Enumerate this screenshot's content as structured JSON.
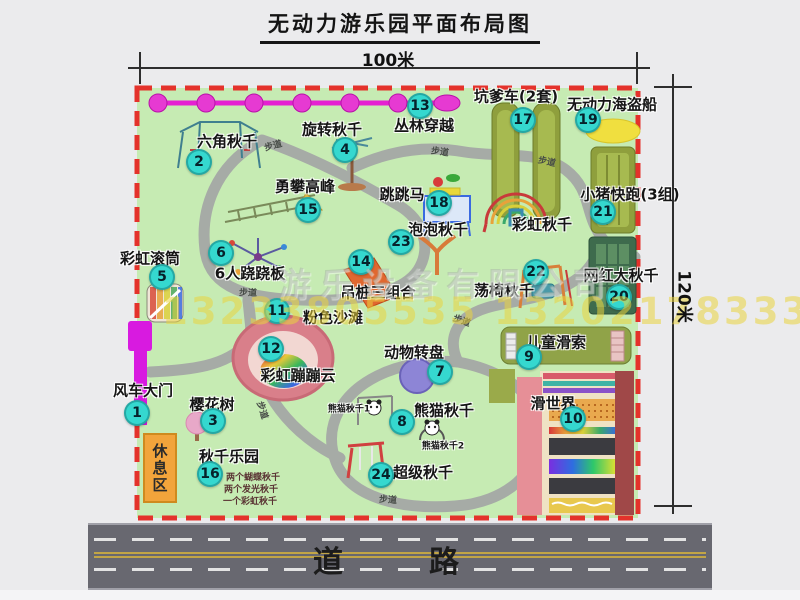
{
  "title": "无动力游乐园平面布局图",
  "dimensions": {
    "top": "100米",
    "right": "120米"
  },
  "watermarks": {
    "company": "游乐设备有限公司",
    "phone": "13233805535 13202178333"
  },
  "road_label": "道　路",
  "rest_area_label": "休息区",
  "walkway_label": "步道",
  "attractions": [
    {
      "num": "1",
      "name": "风车大门"
    },
    {
      "num": "2",
      "name": "六角秋千"
    },
    {
      "num": "3",
      "name": "樱花树"
    },
    {
      "num": "4",
      "name": "旋转秋千"
    },
    {
      "num": "5",
      "name": "彩虹滚筒"
    },
    {
      "num": "6",
      "name": "6人跷跷板"
    },
    {
      "num": "7",
      "name": "动物转盘"
    },
    {
      "num": "8",
      "name": "熊猫秋千"
    },
    {
      "num": "9",
      "name": "儿童滑索"
    },
    {
      "num": "10",
      "name": "滑世界"
    },
    {
      "num": "11",
      "name": "粉色沙滩"
    },
    {
      "num": "12",
      "name": "彩虹蹦蹦云"
    },
    {
      "num": "13",
      "name": "丛林穿越"
    },
    {
      "num": "14",
      "name": "吊桩三组合"
    },
    {
      "num": "15",
      "name": "勇攀高峰"
    },
    {
      "num": "16",
      "name": "秋千乐园"
    },
    {
      "num": "17",
      "name": "坑爹车(2套)"
    },
    {
      "num": "18",
      "name": "跳跳马"
    },
    {
      "num": "19",
      "name": "无动力海盗船"
    },
    {
      "num": "20",
      "name": "网红大秋千"
    },
    {
      "num": "21",
      "name": "小猪快跑(3组)"
    },
    {
      "num": "22",
      "name": "荡椅秋千"
    },
    {
      "num": "23",
      "name": "泡泡秋千"
    },
    {
      "num": "24",
      "name": "超级秋千"
    }
  ],
  "swing_park_notes": [
    "两个蝴蝶秋千",
    "两个发光秋千",
    "一个彩虹秋千"
  ],
  "extra_labels": [
    "彩虹秋千",
    "熊猫秋千1",
    "熊猫秋千2"
  ],
  "colors": {
    "map_green": "#c6ebb3",
    "boundary_red": "#e4322b",
    "badge_cyan": "#35d8cf",
    "zipline_magenta": "#e520d2",
    "gate_magenta": "#d81ae0",
    "rest_orange": "#f2a43b",
    "path_gray": "#a6aba6",
    "road_gray": "#686870"
  }
}
